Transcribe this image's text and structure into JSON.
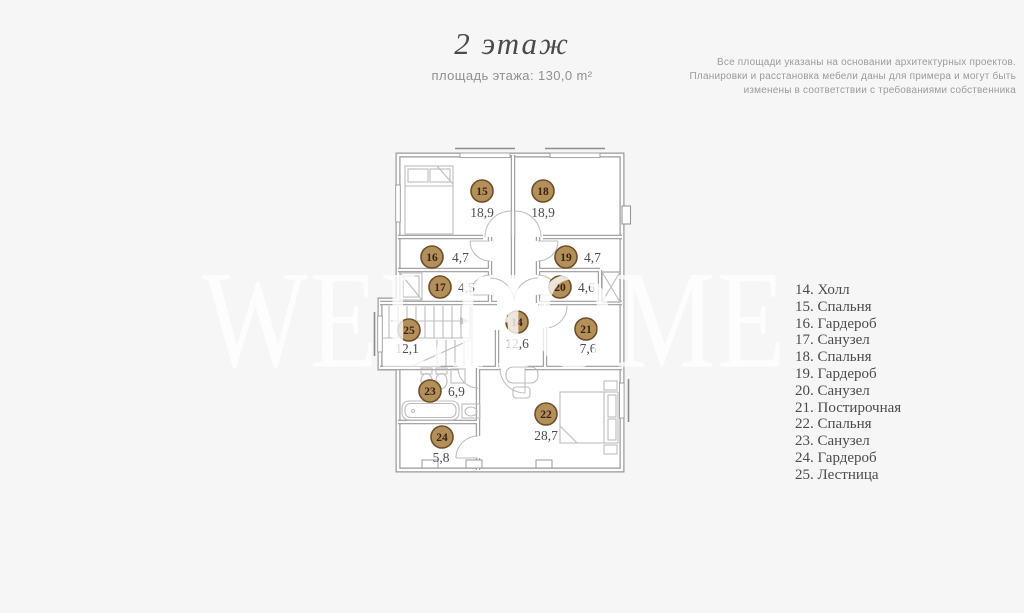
{
  "header": {
    "title": "2 этаж",
    "subtitle": "площадь этажа: 130,0 m²"
  },
  "disclaimer": {
    "lines": [
      "Все площади указаны на основании архитектурных проектов.",
      "Планировки и расстановка мебели даны для примера и могут быть",
      "изменены в соответствии с требованиями собственника"
    ]
  },
  "watermark": "WELHOME",
  "plan": {
    "floor_total_area": "130,0",
    "colors": {
      "marker_fill": "#b3905a",
      "marker_stroke": "#6f4e28",
      "marker_number": "#3b2114",
      "area_text": "#4d4d4d",
      "wall": "#999999"
    },
    "rooms": [
      {
        "num": "15",
        "area": "18,9",
        "cx": 482,
        "cy": 191,
        "lx": 482,
        "ly": 217,
        "anchor": "middle"
      },
      {
        "num": "18",
        "area": "18,9",
        "cx": 543,
        "cy": 191,
        "lx": 543,
        "ly": 217,
        "anchor": "middle"
      },
      {
        "num": "16",
        "area": "4,7",
        "cx": 432,
        "cy": 257,
        "lx": 452,
        "ly": 262,
        "anchor": "start"
      },
      {
        "num": "19",
        "area": "4,7",
        "cx": 566,
        "cy": 257,
        "lx": 584,
        "ly": 262,
        "anchor": "start"
      },
      {
        "num": "17",
        "area": "4,5",
        "cx": 440,
        "cy": 287,
        "lx": 458,
        "ly": 292,
        "anchor": "start"
      },
      {
        "num": "20",
        "area": "4,6",
        "cx": 560,
        "cy": 287,
        "lx": 578,
        "ly": 292,
        "anchor": "start"
      },
      {
        "num": "14",
        "area": "12,6",
        "cx": 517,
        "cy": 322,
        "lx": 517,
        "ly": 348,
        "anchor": "middle"
      },
      {
        "num": "25",
        "area": "12,1",
        "cx": 409,
        "cy": 330,
        "lx": 407,
        "ly": 353,
        "anchor": "middle"
      },
      {
        "num": "21",
        "area": "7,6",
        "cx": 586,
        "cy": 329,
        "lx": 588,
        "ly": 353,
        "anchor": "middle"
      },
      {
        "num": "23",
        "area": "6,9",
        "cx": 430,
        "cy": 391,
        "lx": 448,
        "ly": 396,
        "anchor": "start"
      },
      {
        "num": "22",
        "area": "28,7",
        "cx": 546,
        "cy": 414,
        "lx": 546,
        "ly": 440,
        "anchor": "middle"
      },
      {
        "num": "24",
        "area": "5,8",
        "cx": 442,
        "cy": 437,
        "lx": 441,
        "ly": 462,
        "anchor": "middle"
      }
    ]
  },
  "legend": {
    "items": [
      {
        "num": "14",
        "label": "Холл"
      },
      {
        "num": "15",
        "label": "Спальня"
      },
      {
        "num": "16",
        "label": "Гардероб"
      },
      {
        "num": "17",
        "label": "Санузел"
      },
      {
        "num": "18",
        "label": "Спальня"
      },
      {
        "num": "19",
        "label": "Гардероб"
      },
      {
        "num": "20",
        "label": "Санузел"
      },
      {
        "num": "21",
        "label": "Постирочная"
      },
      {
        "num": "22",
        "label": "Спальня"
      },
      {
        "num": "23",
        "label": "Санузел"
      },
      {
        "num": "24",
        "label": "Гардероб"
      },
      {
        "num": "25",
        "label": "Лестница"
      }
    ]
  }
}
